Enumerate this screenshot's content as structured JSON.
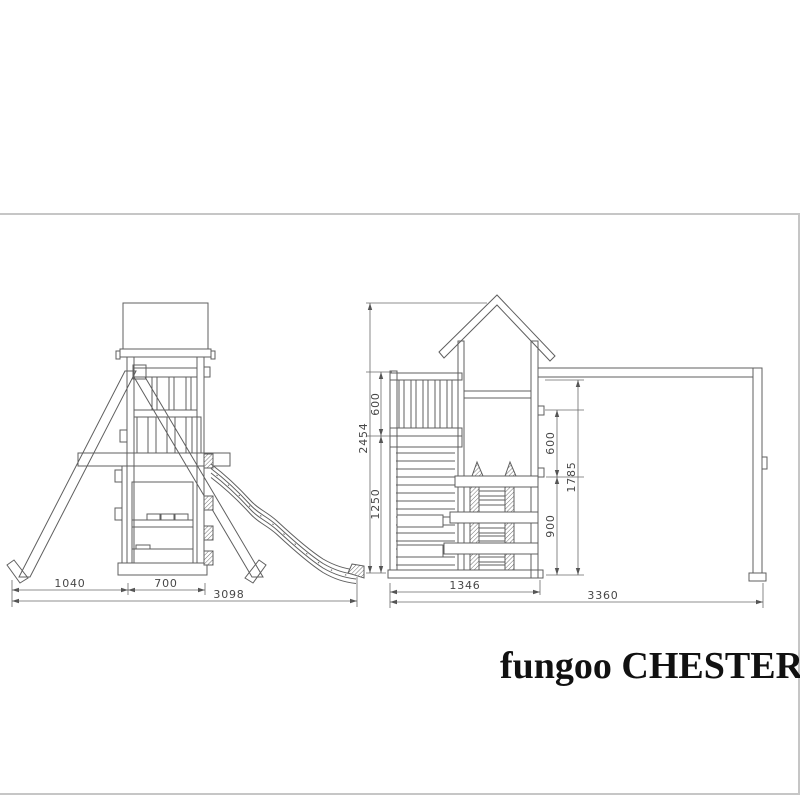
{
  "brand": {
    "name": "fungoo",
    "model": "CHESTER"
  },
  "drawing": {
    "side_view": {
      "dims": {
        "base_left": "1040",
        "base_tower": "700",
        "base_total": "3098"
      }
    },
    "front_view": {
      "dims": {
        "height_total": "2454",
        "height_railing": "600",
        "height_platform": "1250",
        "inner_upper": "600",
        "inner_lower": "900",
        "beam_clearance": "1785",
        "width_tower": "1346",
        "width_total": "3360"
      }
    }
  },
  "colors": {
    "line": "#5f5f5f",
    "dimension": "#6a6a6a",
    "panel_border": "#c6c6c6",
    "brand_text": "#111111",
    "background": "#ffffff"
  }
}
